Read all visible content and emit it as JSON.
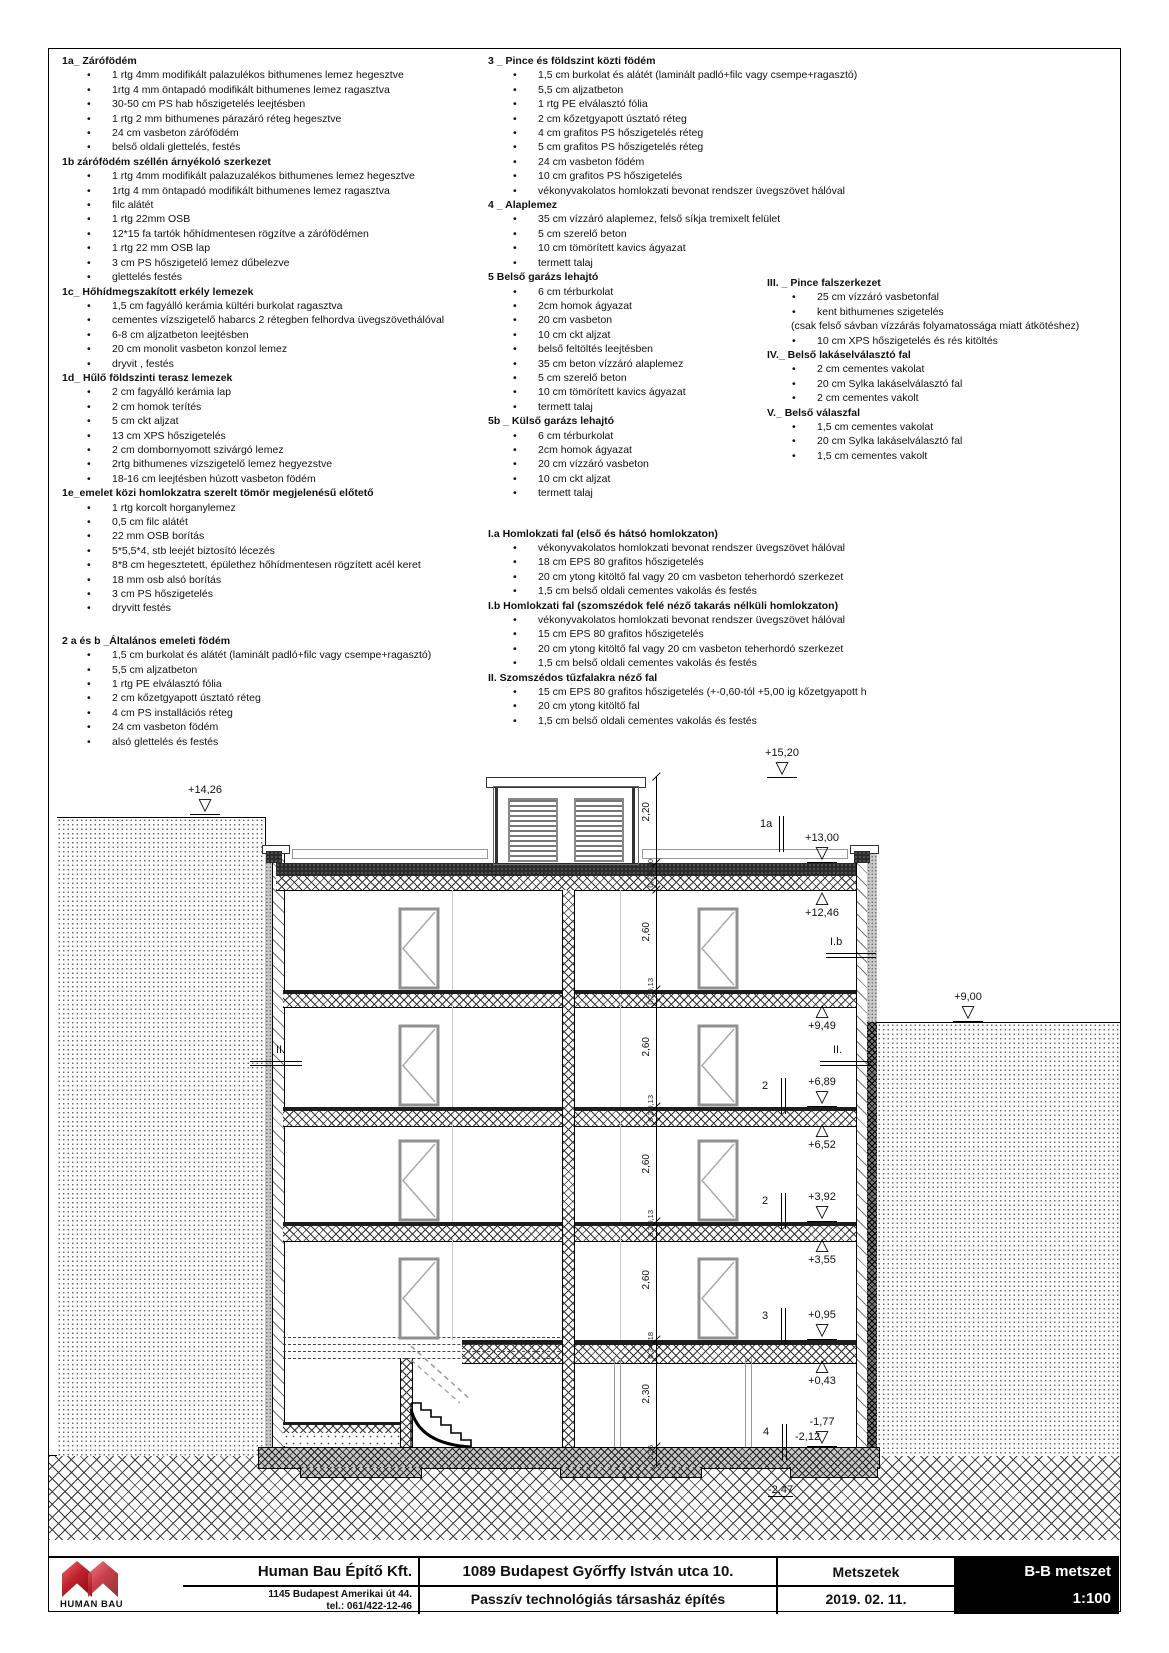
{
  "columns": {
    "left": [
      {
        "title": "1a_ Zárófödém",
        "items": [
          "1 rtg  4mm modifikált palazulékos bithumenes lemez hegesztve",
          "1rtg 4 mm öntapadó modifikált bithumenes lemez ragasztva",
          "30-50 cm PS hab hőszigetelés leejtésben",
          "1 rtg 2 mm bithumenes párazáró réteg hegesztve",
          "24 cm vasbeton zárófödém",
          "belső oldali glettelés, festés"
        ]
      },
      {
        "title": "1b zárófödém széllén árnyékoló szerkezet",
        "items": [
          "1 rtg 4mm modifikált palazuzalékos bithumenes lemez hegesztve",
          "1rtg 4 mm öntapadó modifikált bithumenes lemez ragasztva",
          "filc alátét",
          "1 rtg 22mm OSB",
          "12*15 fa tartók hőhídmentesen rögzítve a zárófödémen",
          "1 rtg 22 mm OSB lap",
          "3 cm PS hőszigetelő lemez dűbelezve",
          "glettelés festés"
        ]
      },
      {
        "title": "1c_ Hőhídmegszakított erkély lemezek",
        "items": [
          "1,5 cm fagyálló kerámia kültéri burkolat ragasztva",
          "cementes vízszigetelő habarcs 2 rétegben felhordva üvegszövethálóval",
          "6-8 cm aljzatbeton leejtésben",
          "20 cm monolit vasbeton konzol lemez",
          "dryvit , festés"
        ]
      },
      {
        "title": "1d_ Hűlő földszinti terasz lemezek",
        "items": [
          "2 cm fagyálló kerámia lap",
          "2 cm homok terítés",
          "5 cm ckt aljzat",
          "13 cm XPS hőszigetelés",
          "2 cm dombornyomott szivárgó lemez",
          "2rtg bithumenes vízszigetelő lemez hegyezstve",
          "18-16 cm leejtésben húzott vasbeton födém"
        ]
      },
      {
        "title": "1e_emelet közi homlokzatra szerelt tömör megjelenésű előtető",
        "items": [
          "1 rtg korcolt horganylemez",
          "0,5 cm filc alátét",
          "22 mm OSB borítás",
          "5*5,5*4, stb leejét biztosító lécezés",
          "8*8 cm hegesztetett, épülethez hőhídmentesen rögzített acél keret",
          "18 mm osb alsó borítás",
          "3 cm PS hőszigetelés",
          "dryvitt festés"
        ]
      },
      {
        "title": "2 a és b _Általános emeleti födém",
        "gap": 18,
        "items": [
          "1,5 cm burkolat és alátét (laminált padló+filc vagy csempe+ragasztó)",
          "5,5 cm aljzatbeton",
          "1 rtg PE elválasztó fólia",
          "2 cm kőzetgyapott úsztató réteg",
          "4 cm PS installációs réteg",
          "24 cm vasbeton födém",
          "alsó glettelés és festés"
        ]
      }
    ],
    "middle": [
      {
        "title": "3 _ Pince és földszint közti födém",
        "items": [
          "1,5 cm burkolat és alátét (laminált padló+filc vagy csempe+ragasztó)",
          "5,5 cm aljzatbeton",
          "1 rtg PE elválasztó fólia",
          "2 cm kőzetgyapott úsztató réteg",
          "4 cm grafitos PS hőszigetelés réteg",
          "5 cm grafitos PS hőszigetelés réteg",
          "24 cm vasbeton födém",
          "10 cm grafitos PS hőszigetelés",
          "vékonyvakolatos homlokzati bevonat rendszer üvegszövet hálóval"
        ]
      },
      {
        "title": "4 _ Alaplemez",
        "items": [
          "35 cm vízzáró alaplemez, felső síkja tremixelt felület",
          "5 cm szerelő beton",
          "10 cm tömörített kavics ágyazat",
          "termett talaj"
        ]
      },
      {
        "title": "5 Belső garázs lehajtó",
        "items": [
          "6 cm térburkolat",
          "2cm homok ágyazat",
          "20 cm vasbeton",
          "10 cm ckt aljzat",
          "belső feltöltés leejtésben",
          "35 cm beton vízzáró alaplemez",
          "5 cm szerelő beton",
          "10 cm tömörített kavics ágyazat",
          "termett talaj"
        ]
      },
      {
        "title": "5b _ Külső garázs lehajtó",
        "items": [
          "6 cm térburkolat",
          "2cm homok ágyazat",
          "20 cm vízzáró vasbeton",
          "10 cm ckt aljzat",
          "termett talaj"
        ]
      },
      {
        "title": "I.a Homlokzati fal (első és hátsó homlokzaton)",
        "gap": 26,
        "items": [
          "vékonyvakolatos homlokzati bevonat rendszer üvegszövet hálóval",
          "18 cm EPS 80 grafitos hőszigetelés",
          "20 cm ytong kitöltő fal vagy 20 cm vasbeton teherhordó szerkezet",
          "1,5 cm belső oldali cementes vakolás és festés"
        ]
      },
      {
        "title": "I.b Homlokzati fal (szomszédok felé néző takarás nélküli homlokzaton)",
        "items": [
          "vékonyvakolatos homlokzati bevonat rendszer üvegszövet hálóval",
          "15 cm EPS 80 grafitos hőszigetelés",
          "20 cm ytong kitöltő fal vagy 20 cm vasbeton teherhordó szerkezet",
          "1,5 cm belső oldali cementes vakolás és festés"
        ]
      },
      {
        "title": "II. Szomszédos tűzfalakra néző fal",
        "items": [
          "15 cm EPS 80 grafitos hőszigetelés (+-0,60-tól +5,00 ig kőzetgyapott h",
          "20 cm ytong kitöltő fal",
          "1,5 cm belső oldali cementes vakolás és festés"
        ]
      }
    ],
    "right": [
      {
        "title": "III. _ Pince falszerkezet",
        "items": [
          "25 cm vízzáró vasbetonfal",
          "kent bithumenes szigetelés",
          "(csak felső sávban vízzárás folyamatossága miatt átkötéshez)",
          "10 cm XPS hőszigetelés és rés kitöltés"
        ]
      },
      {
        "title": "IV._ Belső lakáselválasztó fal",
        "items": [
          "2 cm cementes vakolat",
          "20 cm Sylka lakáselválasztó fal",
          "2 cm cementes vakolt"
        ]
      },
      {
        "title": "V._ Belső válaszfal",
        "items": [
          "1,5 cm cementes vakolat",
          "20 cm Sylka lakáselválasztó fal",
          "1,5 cm cementes vakolt"
        ]
      }
    ]
  },
  "drawing": {
    "elevation_markers": [
      {
        "label": "+15,20",
        "x": 782,
        "y": 778,
        "dir": "down"
      },
      {
        "label": "+14,26",
        "x": 205,
        "y": 815,
        "dir": "down"
      },
      {
        "label": "+13,00",
        "x": 822,
        "y": 863,
        "dir": "down"
      },
      {
        "label": "+12,46",
        "x": 822,
        "y": 891,
        "dir": "up"
      },
      {
        "label": "+9,49",
        "x": 822,
        "y": 1004,
        "dir": "up"
      },
      {
        "label": "+9,00",
        "x": 968,
        "y": 1022,
        "dir": "down"
      },
      {
        "label": "+6,89",
        "x": 822,
        "y": 1107,
        "dir": "down"
      },
      {
        "label": "+6,52",
        "x": 822,
        "y": 1123,
        "dir": "up"
      },
      {
        "label": "+3,92",
        "x": 822,
        "y": 1222,
        "dir": "down"
      },
      {
        "label": "+3,55",
        "x": 822,
        "y": 1238,
        "dir": "up"
      },
      {
        "label": "+0,95",
        "x": 822,
        "y": 1340,
        "dir": "down"
      },
      {
        "label": "+0,43",
        "x": 822,
        "y": 1359,
        "dir": "up"
      },
      {
        "label": "-1,77",
        "x": 822,
        "y": 1447,
        "dir": "down"
      }
    ],
    "extra_labels": [
      {
        "text": "-2,12",
        "x": 795,
        "y": 1431,
        "underline": false
      },
      {
        "text": "-2,47",
        "x": 768,
        "y": 1484,
        "underline": true
      }
    ],
    "cut_labels_v": [
      {
        "text": "1a",
        "x": 760,
        "y": 818
      },
      {
        "text": "2",
        "x": 762,
        "y": 1080
      },
      {
        "text": "2",
        "x": 762,
        "y": 1195
      },
      {
        "text": "3",
        "x": 762,
        "y": 1310
      },
      {
        "text": "4",
        "x": 763,
        "y": 1426
      }
    ],
    "cut_labels_h": [
      {
        "text": "I.b",
        "x": 830,
        "y": 936,
        "lx": 826,
        "ly": 953,
        "len": 50
      },
      {
        "text": "II.",
        "x": 276,
        "y": 1044,
        "lx": 250,
        "ly": 1061,
        "len": 52
      },
      {
        "text": "II.",
        "x": 833,
        "y": 1044,
        "lx": 820,
        "ly": 1061,
        "len": 52
      }
    ],
    "dimensions_big": [
      {
        "v": "2,20",
        "y": 818
      },
      {
        "v": "2,60",
        "y": 938
      },
      {
        "v": "2,60",
        "y": 1053
      },
      {
        "v": "2,60",
        "y": 1170
      },
      {
        "v": "2,60",
        "y": 1286
      },
      {
        "v": "2,30",
        "y": 1400
      }
    ],
    "dimensions_small": [
      {
        "v": "0,30",
        "y": 869
      },
      {
        "v": "0,24",
        "y": 883
      },
      {
        "v": "0,13",
        "y": 988
      },
      {
        "v": "0,24",
        "y": 1000
      },
      {
        "v": "0,13",
        "y": 1105
      },
      {
        "v": "0,24",
        "y": 1117
      },
      {
        "v": "0,13",
        "y": 1220
      },
      {
        "v": "0,24",
        "y": 1232
      },
      {
        "v": "0,18",
        "y": 1342
      },
      {
        "v": "0,34",
        "y": 1354
      },
      {
        "v": "0,35",
        "y": 1455
      }
    ]
  },
  "title_block": {
    "company": "Human Bau Építő Kft.",
    "address1": "1145 Budapest Amerikai út 44.",
    "address2": "tel.: 061/422-12-46",
    "project_address": "1089 Budapest Győrffy István utca 10.",
    "project_name": "Passzív technológiás társasház építés",
    "sheet_type": "Metszetek",
    "date": "2019. 02. 11.",
    "section_name": "B-B metszet",
    "scale": "1:100",
    "logo_text": "HUMAN BAU"
  }
}
